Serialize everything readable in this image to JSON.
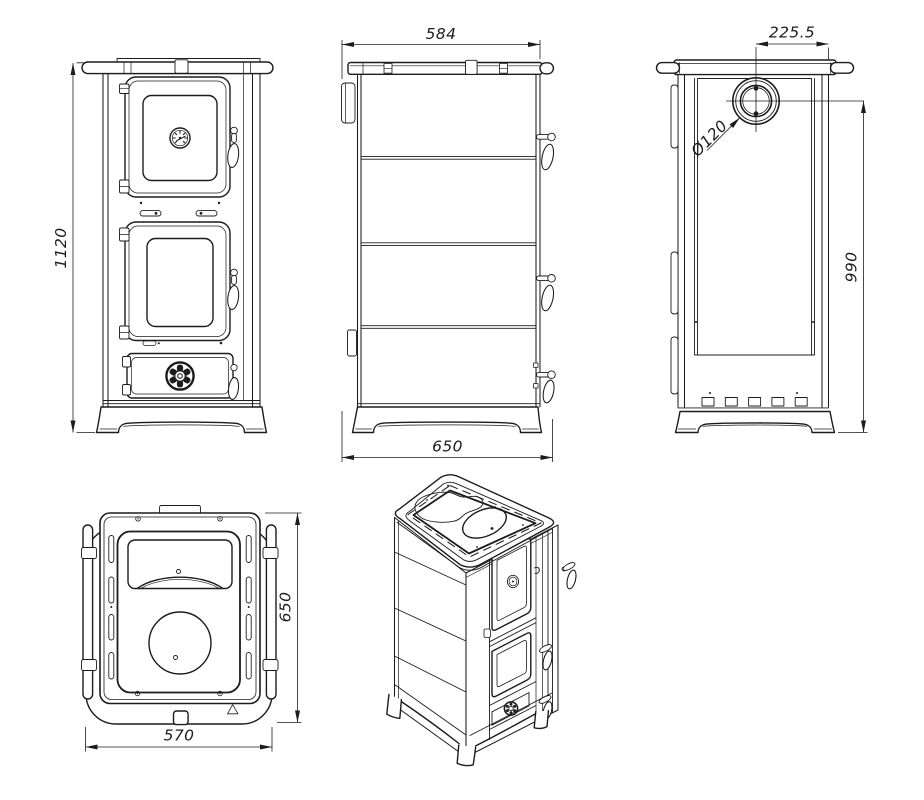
{
  "drawing": {
    "background": "#ffffff",
    "line_color": "#1c1c1c",
    "views": {
      "front": {
        "height": "1120"
      },
      "side": {
        "top_width": "584",
        "bottom_depth": "650"
      },
      "rear": {
        "flue_offset": "225.5",
        "flue_diameter": "Ø120",
        "flue_center_height": "990"
      },
      "top": {
        "depth": "650",
        "width": "570"
      }
    }
  }
}
